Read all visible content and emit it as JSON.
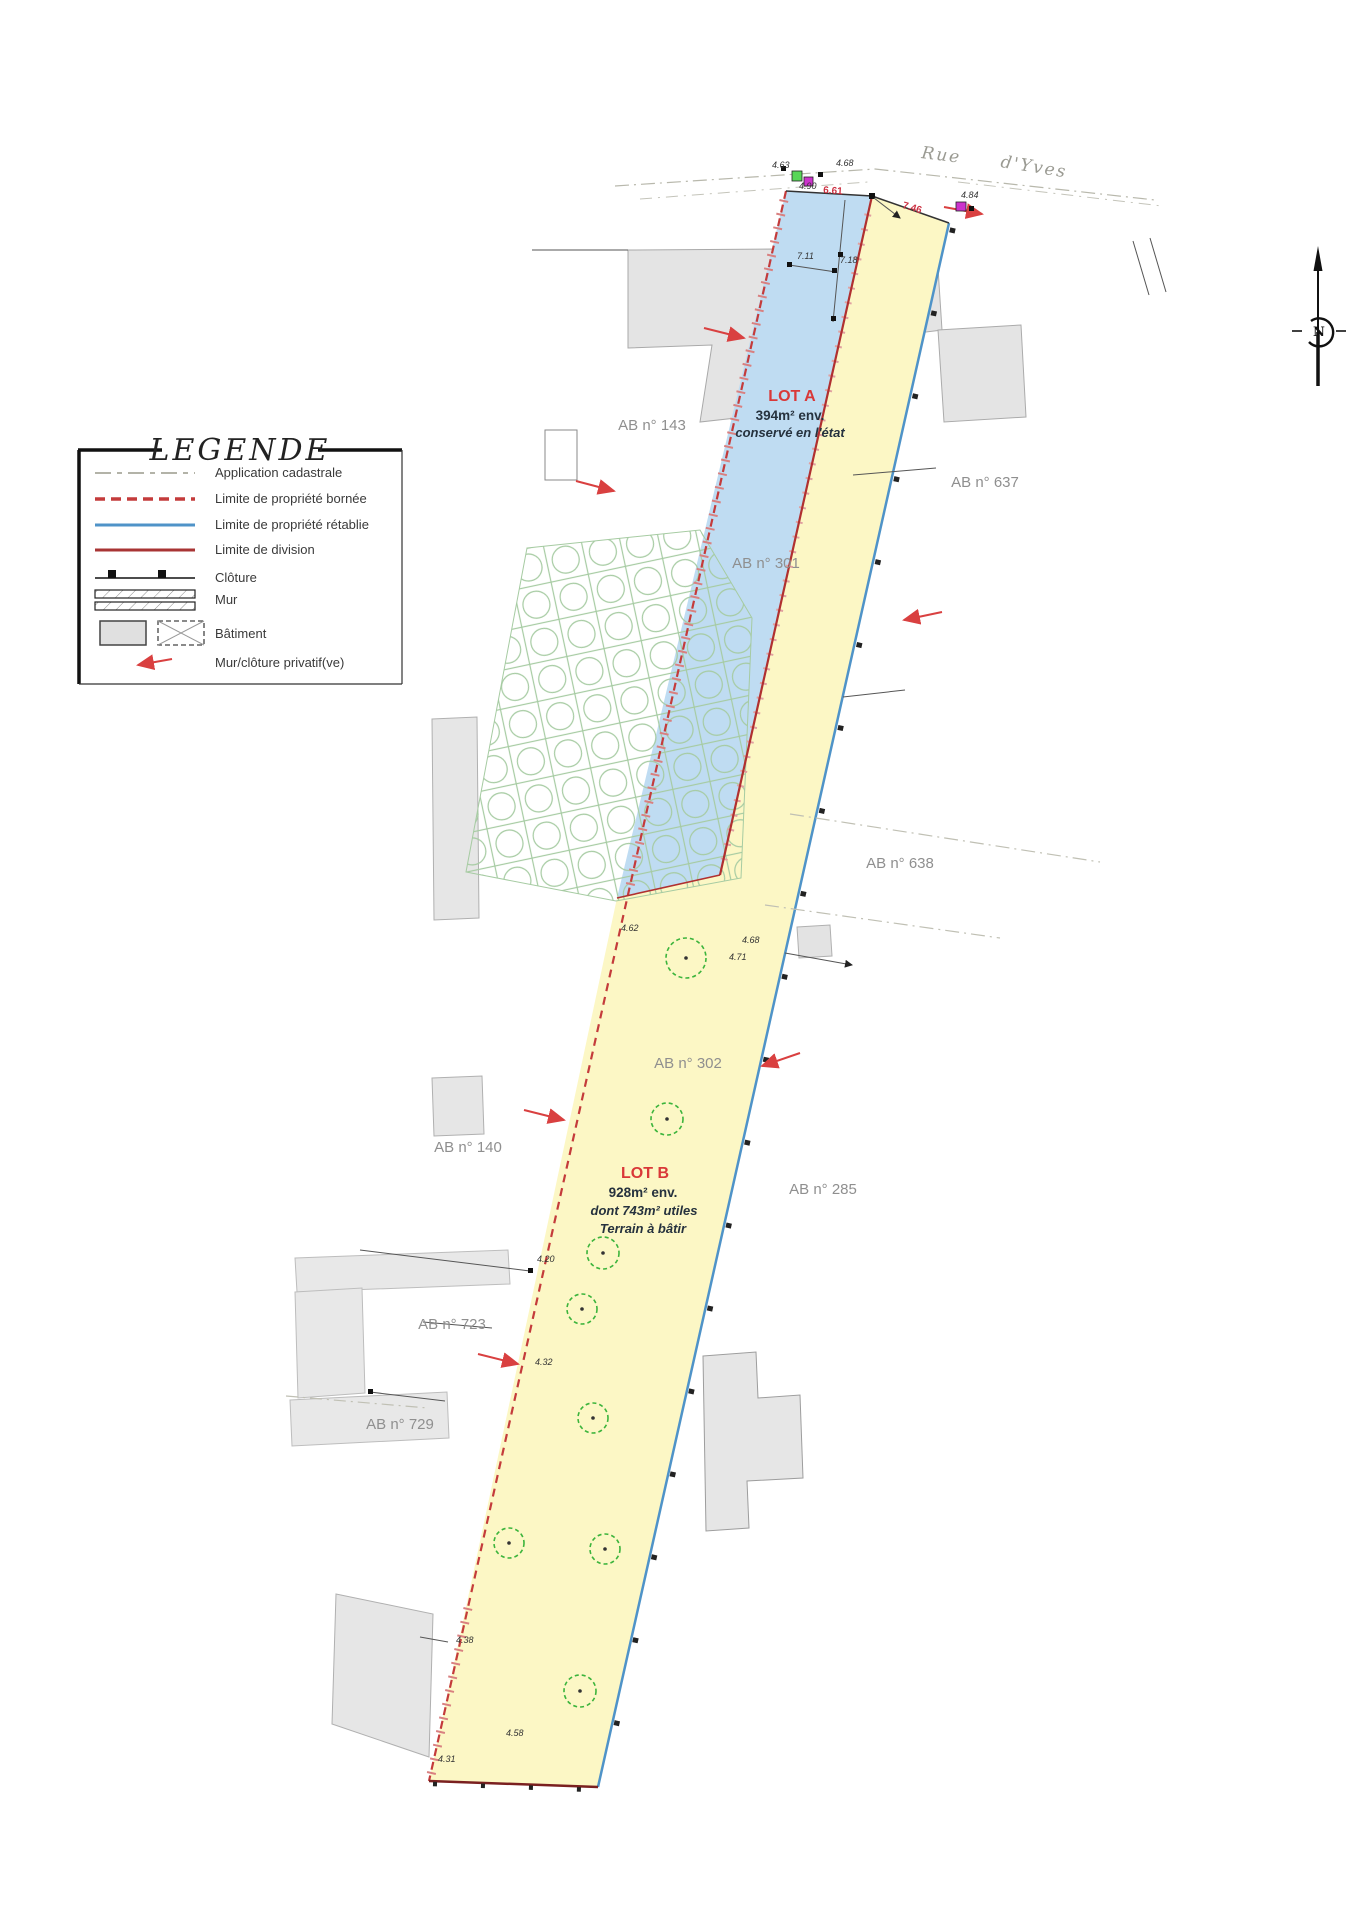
{
  "colors": {
    "lot_a_fill": "#bfdcf2",
    "lot_b_fill": "#fcf7c5",
    "boundary_blue": "#4f93c8",
    "boundary_red_dashed": "#c43b3b",
    "division_red": "#b03030",
    "building_gray": "#e4e4e4",
    "grid_green": "#a6cba2",
    "tree_green": "#3cb43c",
    "parcel_label_gray": "#8f8f8f",
    "street_gray": "#9a9a92",
    "arrow_red": "#d94040"
  },
  "street": {
    "word1": "Rue",
    "word2": "d'Yves"
  },
  "north": {
    "label": "N"
  },
  "legend": {
    "title": "LEGENDE",
    "items": [
      {
        "label": "Application cadastrale",
        "type": "dashdot-gray"
      },
      {
        "label": "Limite de propriété bornée",
        "type": "dashed-red"
      },
      {
        "label": "Limite de propriété rétablie",
        "type": "solid-blue"
      },
      {
        "label": "Limite de division",
        "type": "solid-darkred"
      },
      {
        "label": "Clôture",
        "type": "fence"
      },
      {
        "label": "Mur",
        "type": "wall"
      },
      {
        "label": "Bâtiment",
        "type": "building"
      },
      {
        "label": "Mur/clôture privatif(ve)",
        "type": "red-arrow"
      }
    ]
  },
  "lots": {
    "a": {
      "name": "LOT A",
      "line1": "394m² env.",
      "line2": "conservé en l'état"
    },
    "b": {
      "name": "LOT B",
      "line1": "928m² env.",
      "line2": "dont 743m² utiles",
      "line3": "Terrain à bâtir"
    }
  },
  "parcels": [
    {
      "label": "AB n° 143"
    },
    {
      "label": "AB n° 637"
    },
    {
      "label": "AB n° 301"
    },
    {
      "label": "AB n° 638"
    },
    {
      "label": "AB n° 302"
    },
    {
      "label": "AB n° 140"
    },
    {
      "label": "AB n° 285"
    },
    {
      "label": "AB n° 723"
    },
    {
      "label": "AB n° 729"
    }
  ],
  "dimensions": [
    {
      "value": "6.61"
    },
    {
      "value": "7.46"
    },
    {
      "value": "7.11"
    },
    {
      "value": "7.18"
    }
  ],
  "elevations": [
    {
      "value": "4.63"
    },
    {
      "value": "4.68"
    },
    {
      "value": "4.90"
    },
    {
      "value": "4.84"
    },
    {
      "value": "4.62"
    },
    {
      "value": "4.68"
    },
    {
      "value": "4.71"
    },
    {
      "value": "4.20"
    },
    {
      "value": "4.32"
    },
    {
      "value": "4.38"
    },
    {
      "value": "4.58"
    },
    {
      "value": "4.31"
    }
  ]
}
